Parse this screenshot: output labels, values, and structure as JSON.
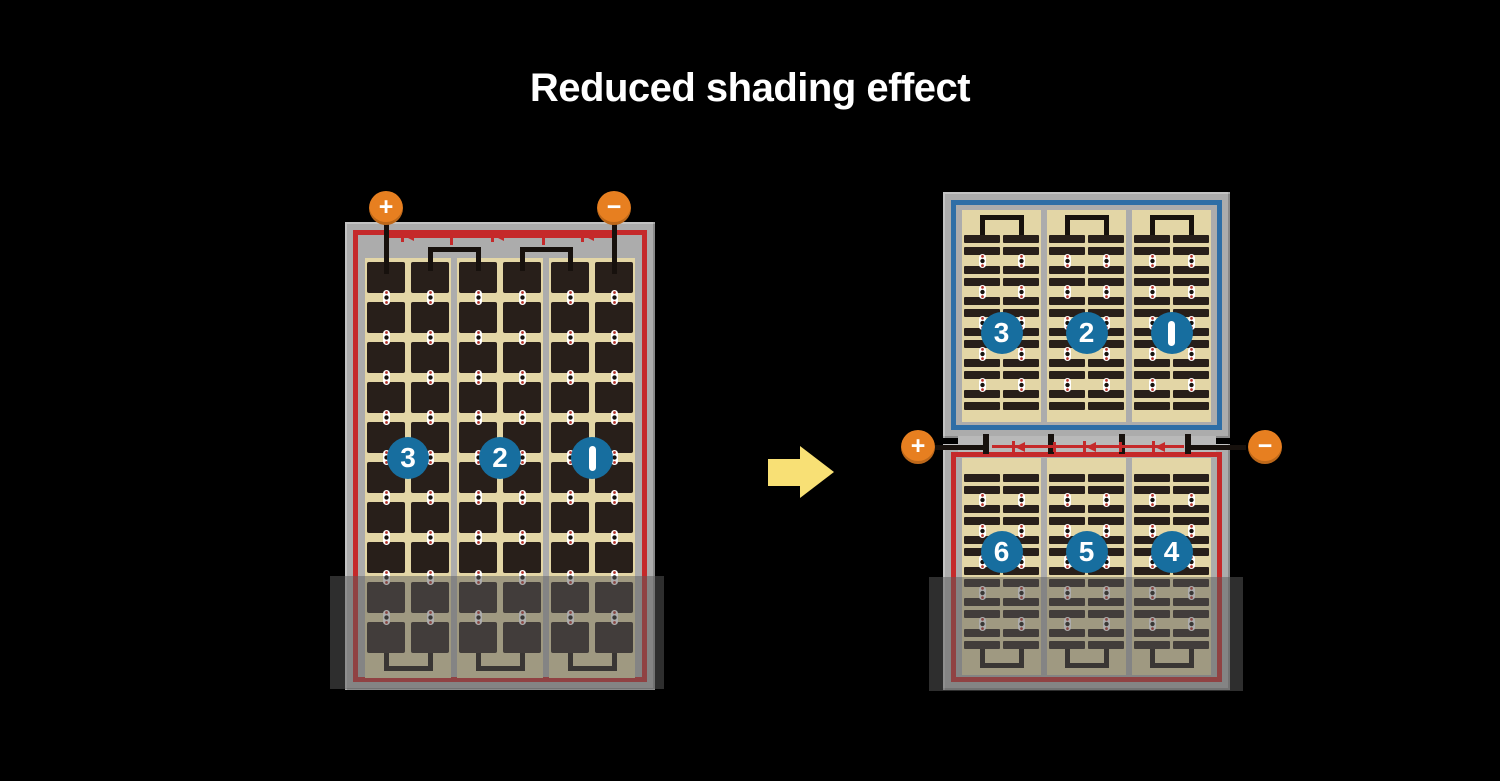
{
  "title": "Reduced shading effect",
  "colors": {
    "background": "#000000",
    "frame_gray": "#ACACAC",
    "string_gap_gray": "#B9B9B9",
    "panel_cream": "#E3D6A6",
    "cell_dark": "#281F1A",
    "wire_black": "#17110d",
    "circuit_red": "#C5292A",
    "string_blue_border": "#2E6EA6",
    "number_circle_blue": "#176E9F",
    "terminal_orange": "#E77F20",
    "arrow_yellow": "#F8E075",
    "shade_overlay": "rgba(92,92,92,0.5)",
    "label_white": "#FFFFFF"
  },
  "before_module": {
    "description": "full-cell module with shaded bottom rows",
    "terminals": [
      {
        "symbol": "+",
        "polarity": "positive"
      },
      {
        "symbol": "−",
        "polarity": "negative"
      }
    ],
    "cell_strings": [
      {
        "label": "3"
      },
      {
        "label": "2"
      },
      {
        "label": "1"
      }
    ],
    "rows_of_cells": 10,
    "columns_per_string": 2,
    "bypass_diodes": 3,
    "shaded": true
  },
  "after_module": {
    "description": "half-cut twin module, only lower half shaded",
    "terminals": [
      {
        "symbol": "+",
        "polarity": "positive"
      },
      {
        "symbol": "−",
        "polarity": "negative"
      }
    ],
    "top_half": {
      "cell_strings": [
        {
          "label": "3"
        },
        {
          "label": "2"
        },
        {
          "label": "1"
        }
      ]
    },
    "bottom_half": {
      "cell_strings": [
        {
          "label": "6"
        },
        {
          "label": "5"
        },
        {
          "label": "4"
        }
      ]
    },
    "half_cell_bar_groups": 6,
    "bypass_diodes": 3,
    "shaded": true
  },
  "transition_arrow": {
    "direction": "right"
  }
}
